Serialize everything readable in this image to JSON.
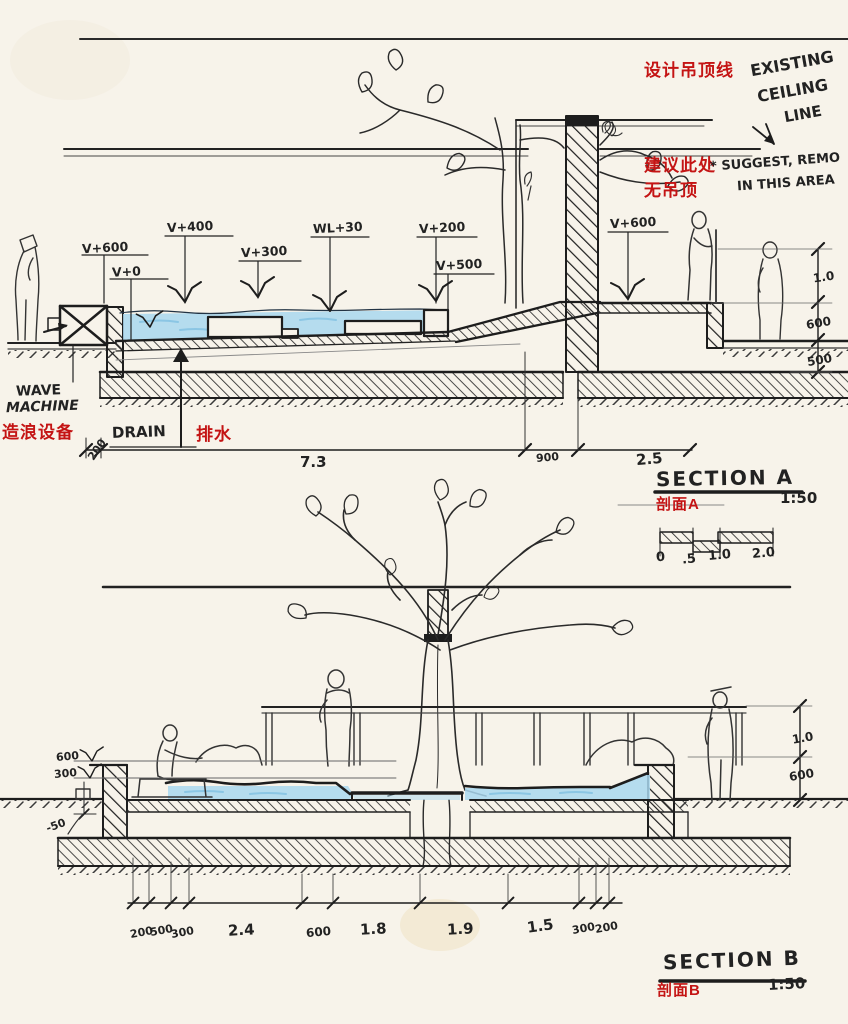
{
  "section_a": {
    "title": "SECTION A",
    "scale_ratio": "1:50",
    "title_cn": "剖面A",
    "notes": {
      "design_ceiling_cn": "设计吊顶线",
      "existing_ceiling_l1": "EXISTING",
      "existing_ceiling_l2": "CEILING",
      "existing_ceiling_l3": "LINE",
      "suggest_cn_l1": "建议此处",
      "suggest_cn_l2": "无吊顶",
      "suggest_en_l1": "* SUGGEST, REMO",
      "suggest_en_l2": "IN THIS AREA",
      "wave_machine_l1": "WAVE",
      "wave_machine_l2": "MACHINE",
      "wave_machine_cn": "造浪设备",
      "drain_en": "DRAIN",
      "drain_cn": "排水"
    },
    "levels": {
      "v600_left": "V+600",
      "v0": "V+0",
      "v400": "V+400",
      "v300": "V+300",
      "wl30": "WL+30",
      "v200": "V+200",
      "v500": "V+500",
      "v600_right": "V+600"
    },
    "dims_right": {
      "d1": "1.0",
      "d2": "600",
      "d3": "500"
    },
    "dims_bottom": {
      "d0": "200",
      "d1": "7.3",
      "d2": "900",
      "d3": "2.5"
    }
  },
  "scale_bar": {
    "t0": "0",
    "t1": ".5",
    "t2": "1.0",
    "t3": "2.0"
  },
  "section_b": {
    "title": "SECTION B",
    "scale_ratio": "1:50",
    "title_cn": "剖面B",
    "levels": {
      "v600": "600",
      "v300": "300",
      "minus50": "-50"
    },
    "dims_right": {
      "d1": "1.0",
      "d2": "600"
    },
    "dims_bottom": {
      "d0": "200",
      "d1": "500",
      "d2": "300",
      "d3": "2.4",
      "d4": "600",
      "d5": "1.8",
      "d6": "1.9",
      "d7": "1.5",
      "d8": "300",
      "d9": "200"
    }
  }
}
